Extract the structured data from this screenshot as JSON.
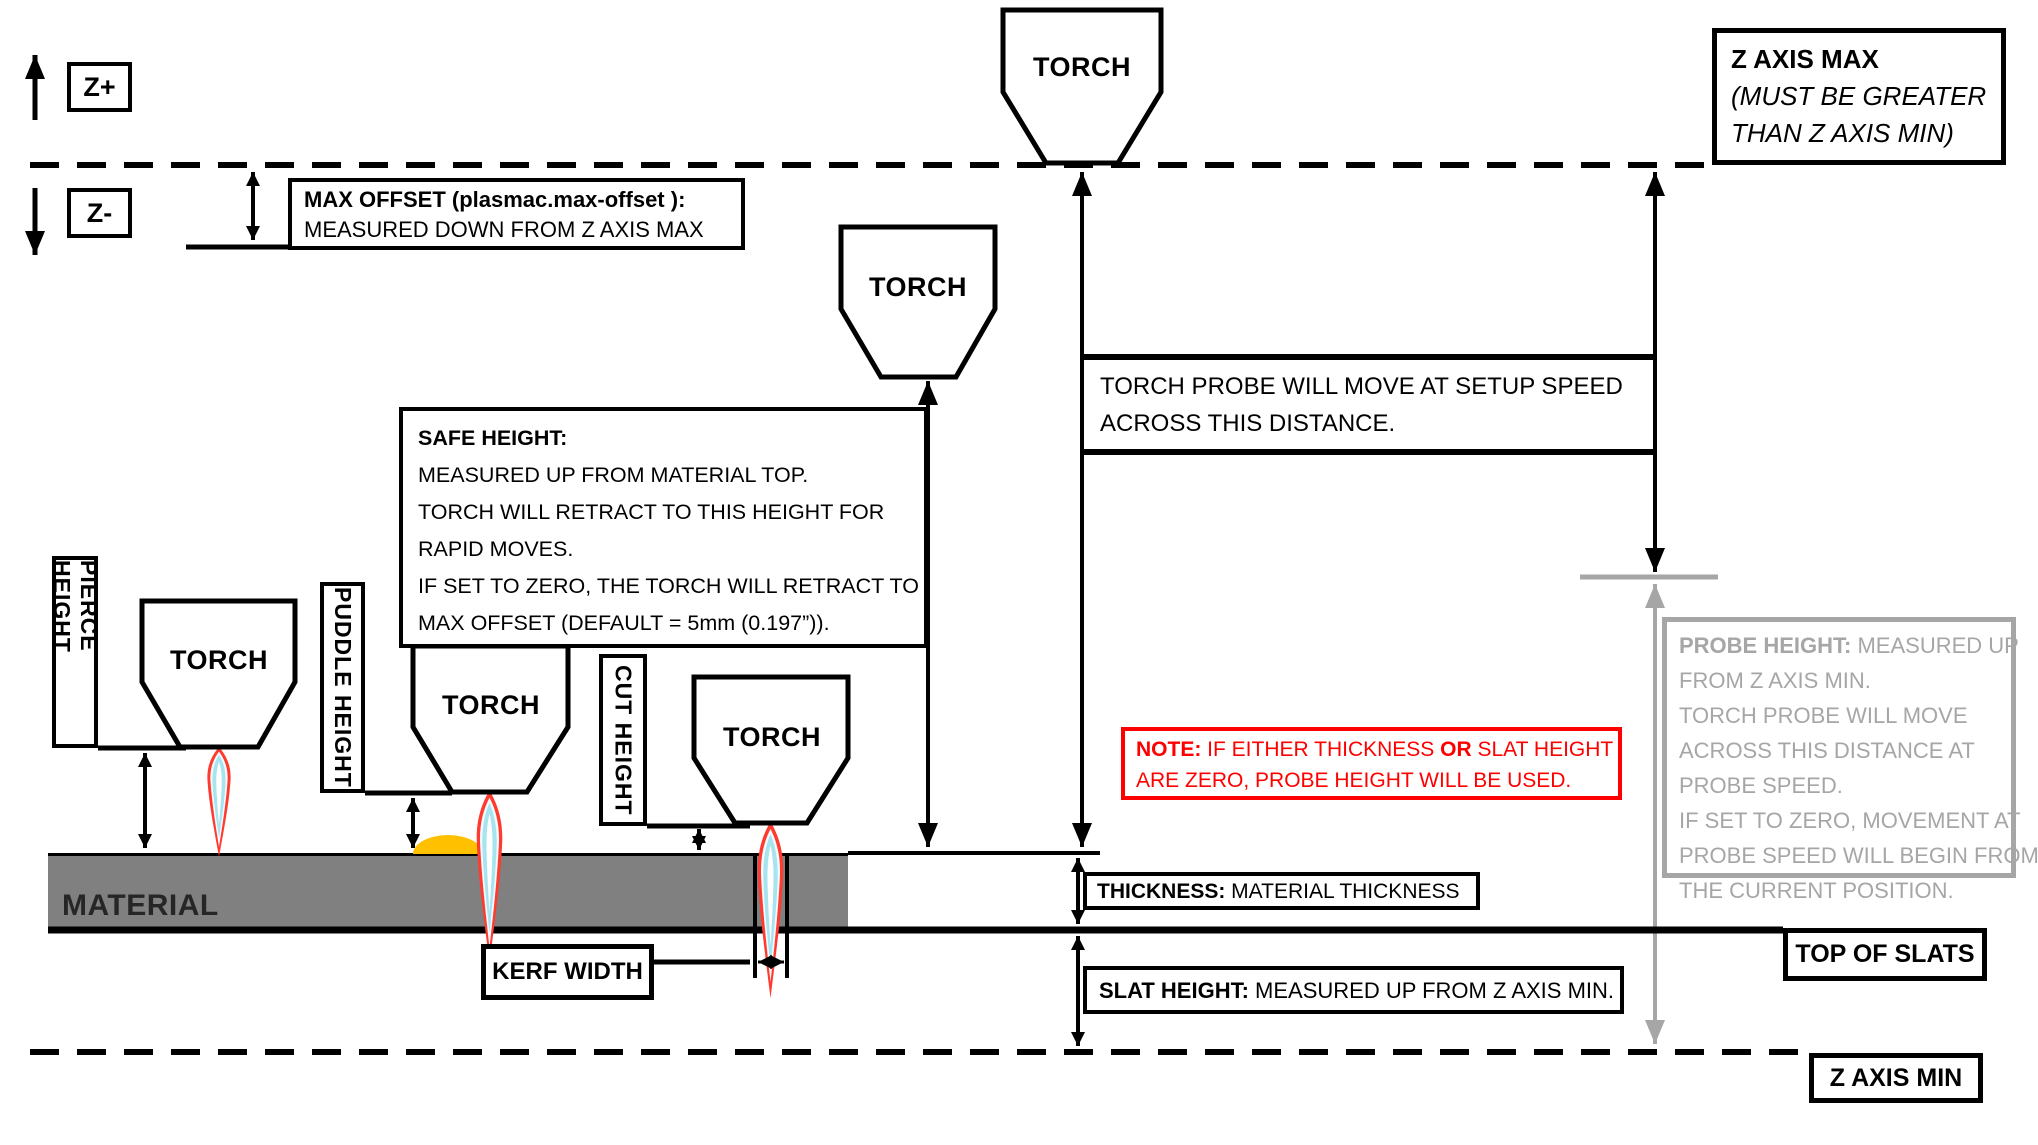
{
  "labels": {
    "torch": "TORCH",
    "z_plus": "Z+",
    "z_minus": "Z-",
    "material": "MATERIAL",
    "pierce_height": "PIERCE HEIGHT",
    "puddle_height": "PUDDLE HEIGHT",
    "cut_height": "CUT HEIGHT",
    "kerf_width": "KERF WIDTH",
    "top_of_slats": "TOP OF SLATS",
    "z_axis_min": "Z AXIS MIN"
  },
  "max_offset": {
    "title": "MAX OFFSET (plasmac.max-offset ):",
    "line2": "MEASURED DOWN FROM Z AXIS MAX"
  },
  "z_axis_max": {
    "line1": "Z AXIS MAX",
    "line2": "(MUST BE GREATER",
    "line3": "THAN Z AXIS MIN)"
  },
  "torch_probe": {
    "line1": "TORCH PROBE WILL MOVE AT SETUP SPEED",
    "line2": "ACROSS THIS DISTANCE."
  },
  "safe_height": {
    "title": "SAFE HEIGHT:",
    "lines": [
      "MEASURED UP FROM MATERIAL TOP.",
      "TORCH WILL RETRACT TO THIS HEIGHT FOR",
      "RAPID MOVES.",
      "IF SET TO ZERO, THE TORCH WILL RETRACT TO",
      "MAX OFFSET (DEFAULT = 5mm (0.197”))."
    ]
  },
  "note": {
    "bold1": "NOTE:",
    "t1": "  IF EITHER THICKNESS ",
    "bold2": "OR",
    "t2": " SLAT HEIGHT",
    "line2": "ARE ZERO, PROBE HEIGHT WILL BE USED."
  },
  "probe_height": {
    "title": "PROBE HEIGHT:",
    "title_rest": " MEASURED UP",
    "lines": [
      "FROM Z AXIS MIN.",
      "TORCH PROBE WILL MOVE",
      "ACROSS THIS DISTANCE AT",
      "PROBE SPEED.",
      "IF SET TO ZERO,  MOVEMENT AT",
      "PROBE SPEED WILL BEGIN FROM",
      "THE CURRENT POSITION."
    ]
  },
  "thickness": {
    "title": "THICKNESS:",
    "rest": "  MATERIAL THICKNESS"
  },
  "slat_height": {
    "title": "SLAT HEIGHT:",
    "rest": "  MEASURED UP FROM Z AXIS MIN."
  },
  "colors": {
    "red": "#ff0000",
    "gray": "#a6a6a6",
    "material": "#808080",
    "puddle": "#ffc000",
    "flame_outer": "#ff3b30",
    "flame_inner": "#a8e4f0",
    "ink": "#000000"
  }
}
